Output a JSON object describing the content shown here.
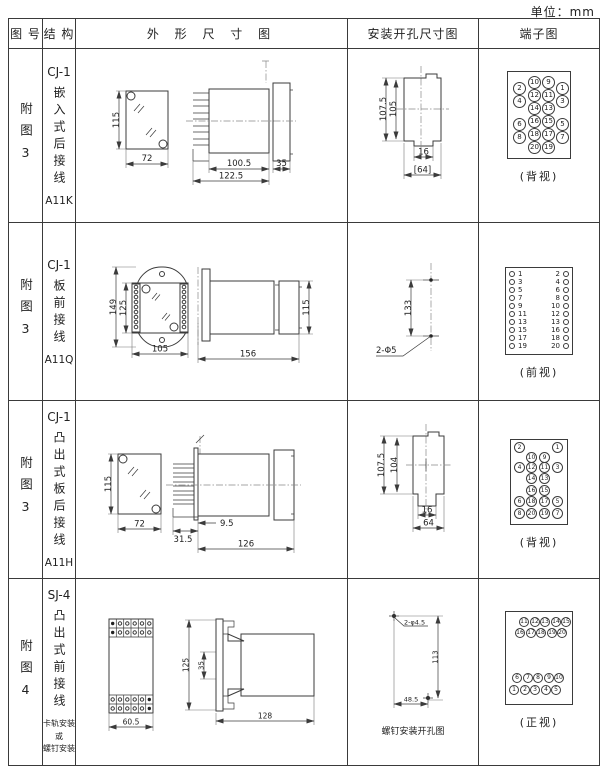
{
  "unit_label": "单位：mm",
  "headers": [
    "图 号",
    "结 构",
    "外 形 尺 寸 图",
    "安装开孔尺寸图",
    "端子图"
  ],
  "rows": [
    {
      "fig": "附图3",
      "model": "CJ-1",
      "mount": "嵌入式后接线",
      "code": "A11K",
      "dims": {
        "front_h": "115",
        "front_w": "72",
        "body": "100.5",
        "total": "122.5",
        "flange": "35",
        "inst_h1": "107.5",
        "inst_h2": "105",
        "inst_w1": "16",
        "inst_w2": "[64]"
      },
      "terminal": {
        "caption": "(背视)",
        "circles": [
          {
            "n": "10",
            "x": 20,
            "y": 4
          },
          {
            "n": "9",
            "x": 34,
            "y": 4
          },
          {
            "n": "2",
            "x": 5,
            "y": 10
          },
          {
            "n": "1",
            "x": 48,
            "y": 10
          },
          {
            "n": "12",
            "x": 20,
            "y": 17
          },
          {
            "n": "11",
            "x": 34,
            "y": 17
          },
          {
            "n": "4",
            "x": 5,
            "y": 23
          },
          {
            "n": "3",
            "x": 48,
            "y": 23
          },
          {
            "n": "14",
            "x": 20,
            "y": 30
          },
          {
            "n": "13",
            "x": 34,
            "y": 30
          },
          {
            "n": "16",
            "x": 20,
            "y": 43
          },
          {
            "n": "15",
            "x": 34,
            "y": 43
          },
          {
            "n": "6",
            "x": 5,
            "y": 46
          },
          {
            "n": "5",
            "x": 48,
            "y": 46
          },
          {
            "n": "18",
            "x": 20,
            "y": 56
          },
          {
            "n": "17",
            "x": 34,
            "y": 56
          },
          {
            "n": "8",
            "x": 5,
            "y": 59
          },
          {
            "n": "7",
            "x": 48,
            "y": 59
          },
          {
            "n": "20",
            "x": 20,
            "y": 69
          },
          {
            "n": "19",
            "x": 34,
            "y": 69
          }
        ]
      }
    },
    {
      "fig": "附图3",
      "model": "CJ-1",
      "mount": "板前接线",
      "code": "A11Q",
      "dims": {
        "h1": "149",
        "h2": "125",
        "w": "105",
        "side_w": "156",
        "side_h": "115",
        "inst_v": "133",
        "inst_label": "2-Φ5"
      },
      "terminal": {
        "caption": "(前视)",
        "pairs": [
          {
            "l": "1",
            "r": "2"
          },
          {
            "l": "3",
            "r": "4"
          },
          {
            "l": "5",
            "r": "6"
          },
          {
            "l": "7",
            "r": "8"
          },
          {
            "l": "9",
            "r": "10"
          },
          {
            "l": "11",
            "r": "12"
          },
          {
            "l": "13",
            "r": "13"
          },
          {
            "l": "15",
            "r": "16"
          },
          {
            "l": "17",
            "r": "18"
          },
          {
            "l": "19",
            "r": "20"
          }
        ]
      }
    },
    {
      "fig": "附图3",
      "model": "CJ-1",
      "mount": "凸出式板后接线",
      "code": "A11H",
      "dims": {
        "front_h": "115",
        "front_w": "72",
        "pins": "31.5",
        "offset": "9.5",
        "body": "126",
        "inst_h1": "107.5",
        "inst_h2": "104",
        "inst_w1": "16",
        "inst_w2": "64"
      },
      "terminal": {
        "caption": "(背视)",
        "circles": [
          {
            "n": "2",
            "x": 3,
            "y": 2
          },
          {
            "n": "1",
            "x": 41,
            "y": 2
          },
          {
            "n": "10",
            "x": 15,
            "y": 12
          },
          {
            "n": "9",
            "x": 28,
            "y": 12
          },
          {
            "n": "4",
            "x": 3,
            "y": 22
          },
          {
            "n": "12",
            "x": 15,
            "y": 22
          },
          {
            "n": "11",
            "x": 28,
            "y": 22
          },
          {
            "n": "3",
            "x": 41,
            "y": 22
          },
          {
            "n": "14",
            "x": 15,
            "y": 33
          },
          {
            "n": "13",
            "x": 28,
            "y": 33
          },
          {
            "n": "16",
            "x": 15,
            "y": 45
          },
          {
            "n": "15",
            "x": 28,
            "y": 45
          },
          {
            "n": "6",
            "x": 3,
            "y": 56
          },
          {
            "n": "18",
            "x": 15,
            "y": 56
          },
          {
            "n": "17",
            "x": 28,
            "y": 56
          },
          {
            "n": "5",
            "x": 41,
            "y": 56
          },
          {
            "n": "8",
            "x": 3,
            "y": 68
          },
          {
            "n": "20",
            "x": 15,
            "y": 68
          },
          {
            "n": "19",
            "x": 28,
            "y": 68
          },
          {
            "n": "7",
            "x": 41,
            "y": 68
          }
        ]
      }
    },
    {
      "fig": "附图4",
      "model": "SJ-4",
      "mount": "凸出式前接线",
      "note": [
        "卡轨安装",
        "或",
        "螺钉安装"
      ],
      "dims": {
        "front_w": "60.5",
        "side_h": "125",
        "side_inner": "35",
        "side_len": "128",
        "inst_label": "2-φ4.5",
        "inst_v": "113",
        "inst_w": "48.5",
        "inst_caption": "螺钉安装开孔图"
      },
      "terminal": {
        "caption": "(正视)",
        "circles": [
          {
            "n": "11",
            "x": 13,
            "y": 5
          },
          {
            "n": "12",
            "x": 24,
            "y": 5
          },
          {
            "n": "13",
            "x": 34,
            "y": 5
          },
          {
            "n": "14",
            "x": 45,
            "y": 5
          },
          {
            "n": "15",
            "x": 55,
            "y": 5
          },
          {
            "n": "16",
            "x": 9,
            "y": 16
          },
          {
            "n": "17",
            "x": 20,
            "y": 16
          },
          {
            "n": "18",
            "x": 30,
            "y": 16
          },
          {
            "n": "19",
            "x": 41,
            "y": 16
          },
          {
            "n": "20",
            "x": 51,
            "y": 16
          },
          {
            "n": "6",
            "x": 6,
            "y": 61
          },
          {
            "n": "7",
            "x": 17,
            "y": 61
          },
          {
            "n": "8",
            "x": 27,
            "y": 61
          },
          {
            "n": "9",
            "x": 38,
            "y": 61
          },
          {
            "n": "10",
            "x": 48,
            "y": 61
          },
          {
            "n": "1",
            "x": 3,
            "y": 73
          },
          {
            "n": "2",
            "x": 14,
            "y": 73
          },
          {
            "n": "3",
            "x": 24,
            "y": 73
          },
          {
            "n": "4",
            "x": 35,
            "y": 73
          },
          {
            "n": "5",
            "x": 45,
            "y": 73
          }
        ]
      }
    }
  ]
}
